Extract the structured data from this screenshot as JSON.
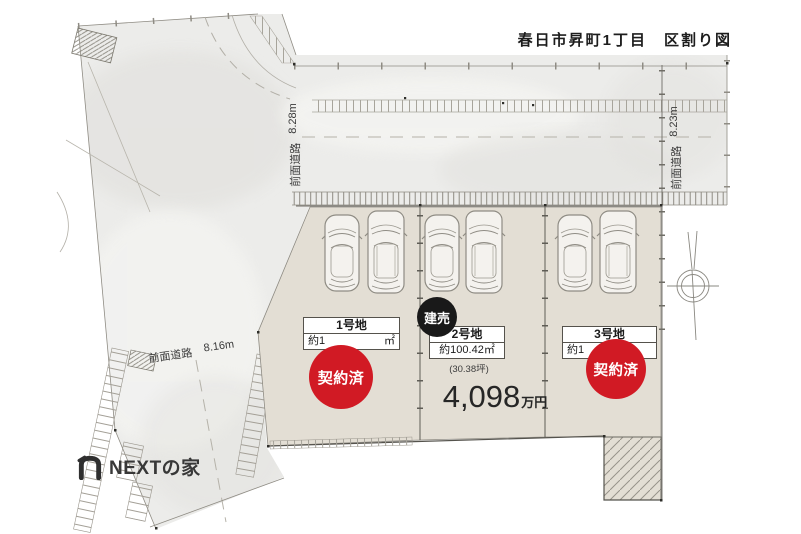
{
  "title": "春日市昇町1丁目　区割り図",
  "roads": {
    "top": {
      "name": "前面道路",
      "width": "8.28m"
    },
    "right": {
      "name": "前面道路",
      "width": "8.23m"
    },
    "left": {
      "name": "前面道路",
      "width": "8.16m"
    }
  },
  "lots": [
    {
      "id": "lot-1",
      "name": "1号地",
      "area_fragment_left": "約1",
      "area_fragment_right": "㎡",
      "status": "契約済"
    },
    {
      "id": "lot-2",
      "name": "2号地",
      "area": "約100.42㎡",
      "area_tsubo": "(30.38坪)",
      "badge": "建売",
      "price_value": "4,098",
      "price_unit": "万円"
    },
    {
      "id": "lot-3",
      "name": "3号地",
      "area_fragment_left": "約1",
      "area_fragment_right": "",
      "status": "契約済"
    }
  ],
  "logo": {
    "brand": "NEXTの家"
  },
  "colors": {
    "sold_red": "#d11a24",
    "badge_black": "#191919",
    "lot_fill": "#e3ded4",
    "road_fill": "#ececea"
  }
}
